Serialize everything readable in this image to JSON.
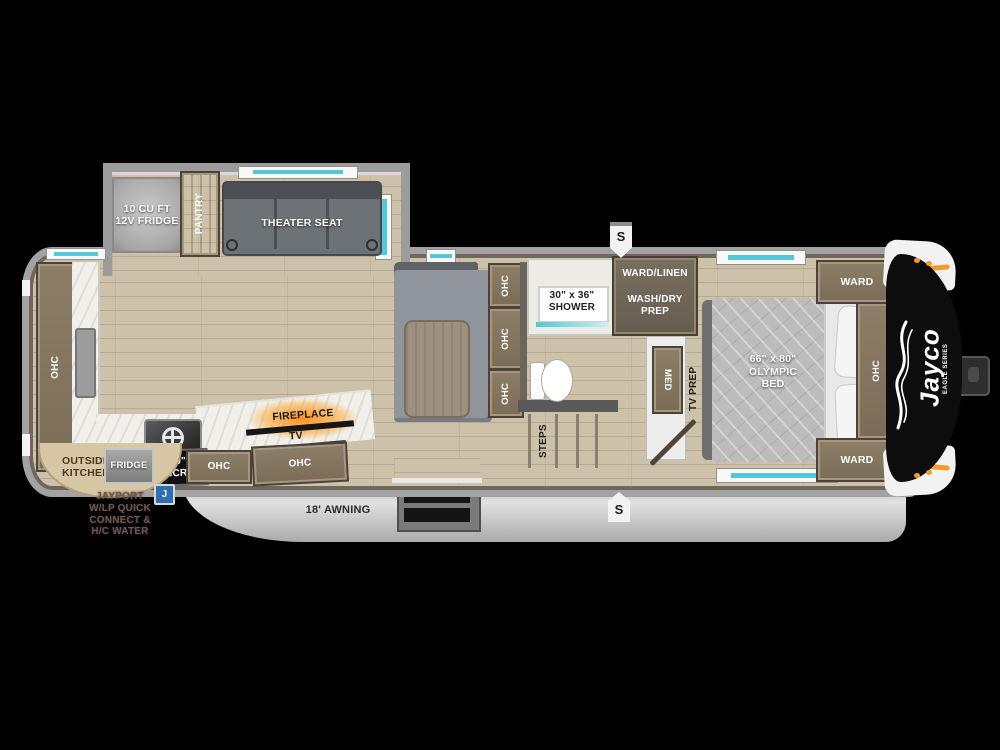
{
  "colors": {
    "teal": "#52c8d8",
    "orange": "#f29b2e",
    "wood": "#cdc1aa",
    "cabinet": "#85765f",
    "body-gray": "#a2a2a2",
    "badge-blue": "#2f6fae",
    "cap-black": "#0d0d0d"
  },
  "floorplan": {
    "brand": {
      "logo": "Jayco",
      "sub": "EAGLE SERIES"
    },
    "slide": {
      "fridge": "10 CU FT\n12V FRIDGE",
      "pantry": "PANTRY",
      "theater_seat": "THEATER SEAT"
    },
    "kitchen": {
      "rear_ohc": "OHC",
      "cooktop_micro": "30\"\nMICRO",
      "ohc_left": "OHC",
      "ohc_right": "OHC",
      "fireplace": "FIREPLACE",
      "tv": "TV"
    },
    "outside_kitchen": {
      "label": "OUTSIDE\nKITCHEN",
      "fridge": "FRIDGE",
      "badge": "J",
      "jayport": "JAYPORT\nW/LP QUICK\nCONNECT &\nH/C WATER"
    },
    "dinette": {
      "ohc": [
        "OHC",
        "OHC",
        "OHC"
      ]
    },
    "bathroom": {
      "shower": "30\" x 36\"\nSHOWER",
      "steps": "STEPS"
    },
    "utility": {
      "ward_linen": "WARD/LINEN",
      "wash_dry": "WASH/DRY\nPREP",
      "med": "MED",
      "tv_prep": "TV PREP"
    },
    "bedroom": {
      "bed": "66\" x 80\"\nOLYMPIC\nBED",
      "ward_top": "WARD",
      "ward_bottom": "WARD",
      "ohc": "OHC"
    },
    "exterior": {
      "awning": "18' AWNING",
      "speaker": "S"
    }
  }
}
